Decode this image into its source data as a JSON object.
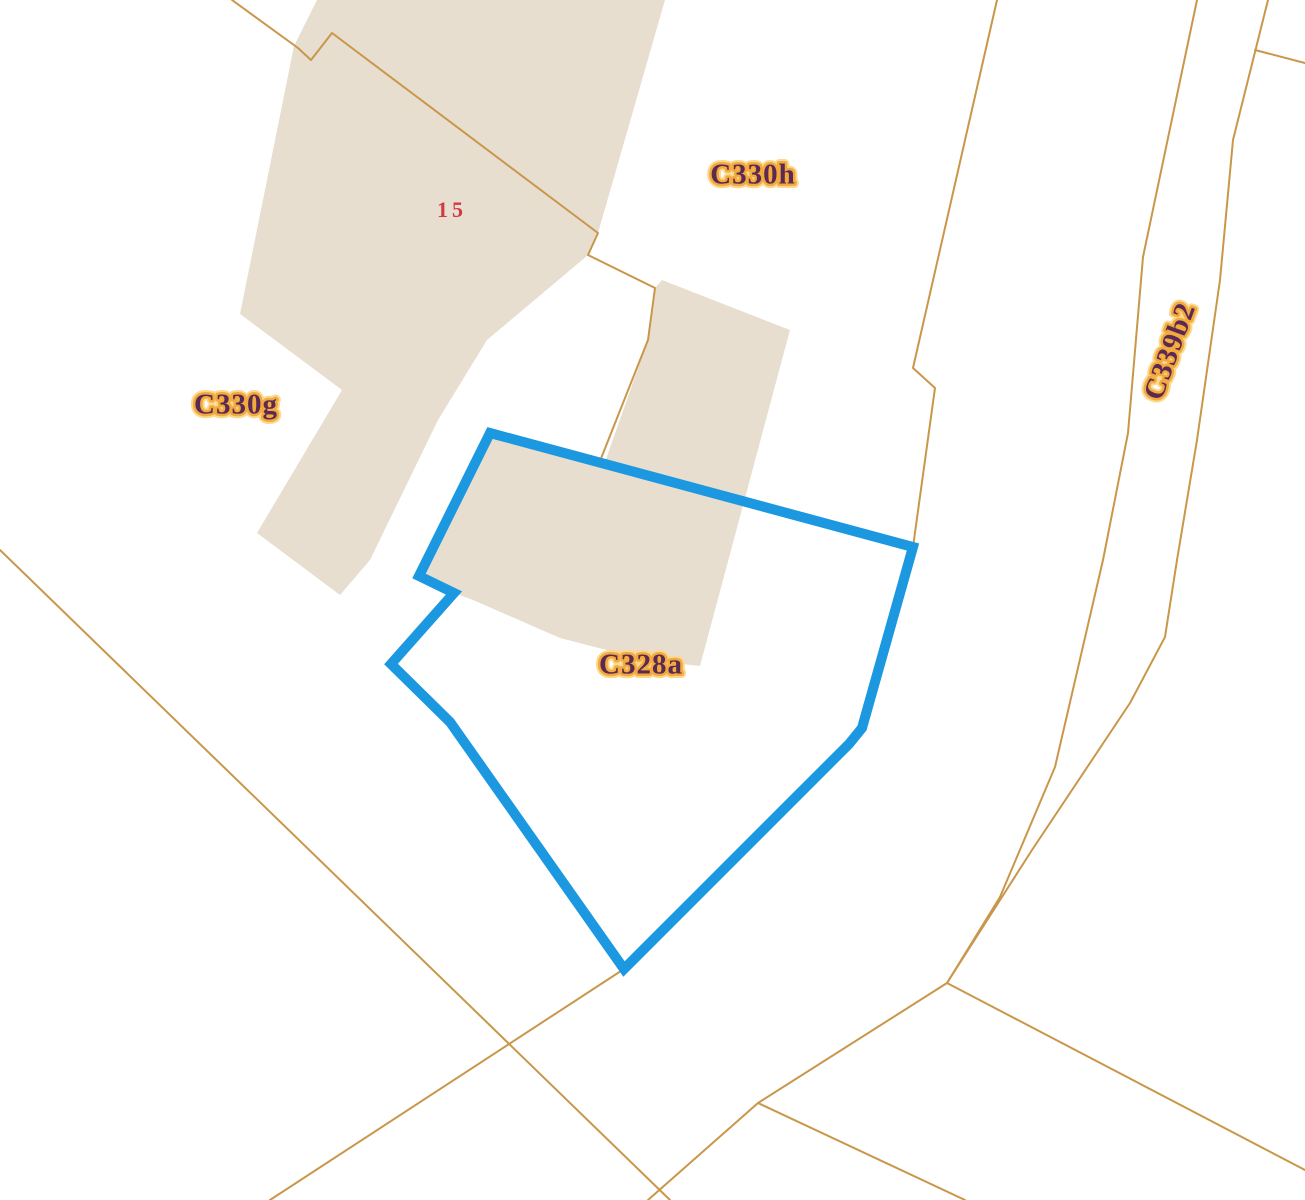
{
  "map": {
    "title": "cadastral-parcel-map",
    "colors": {
      "background": "#ffffff",
      "building_fill": "#e7decf",
      "boundary_line": "#c9974a",
      "selected_parcel_stroke": "#1b98e0",
      "label_fill": "#5a2a52",
      "label_halo": "#f3a93d",
      "label_halo_glow": "#fbd98d",
      "house_number_color": "#cf3a45"
    },
    "labels": [
      {
        "id": "c330h",
        "text": "C330h",
        "x": 753,
        "y": 177,
        "rotation": 0,
        "font_size": 29,
        "type": "parcel"
      },
      {
        "id": "c330g",
        "text": "C330g",
        "x": 236,
        "y": 407,
        "rotation": 0,
        "font_size": 29,
        "type": "parcel"
      },
      {
        "id": "c328a",
        "text": "C328a",
        "x": 641,
        "y": 667,
        "rotation": 0,
        "font_size": 29,
        "type": "parcel"
      },
      {
        "id": "c339b2",
        "text": "C339b2",
        "x": 1172,
        "y": 352,
        "rotation": -70,
        "font_size": 29,
        "type": "parcel"
      },
      {
        "id": "house-15",
        "text": "15",
        "x": 452,
        "y": 212,
        "rotation": 0,
        "font_size": 22,
        "type": "house-number"
      }
    ],
    "selected_parcel": {
      "label": "C328a",
      "stroke_width": 10,
      "points": [
        [
          490,
          433
        ],
        [
          913,
          547
        ],
        [
          862,
          728
        ],
        [
          849,
          744
        ],
        [
          624,
          969
        ],
        [
          450,
          722
        ],
        [
          391,
          664
        ],
        [
          454,
          593
        ],
        [
          419,
          576
        ]
      ]
    },
    "buildings": [
      {
        "name": "building-15",
        "points": [
          [
            317,
            0
          ],
          [
            665,
            0
          ],
          [
            598,
            233
          ],
          [
            588,
            255
          ],
          [
            487,
            340
          ],
          [
            438,
            420
          ],
          [
            370,
            560
          ],
          [
            340,
            595
          ],
          [
            257,
            533
          ],
          [
            342,
            390
          ],
          [
            240,
            314
          ],
          [
            294,
            46
          ]
        ]
      },
      {
        "name": "building-c328a",
        "points": [
          [
            655,
            288
          ],
          [
            662,
            280
          ],
          [
            790,
            330
          ],
          [
            700,
            666
          ],
          [
            645,
            660
          ],
          [
            560,
            638
          ],
          [
            473,
            600
          ],
          [
            454,
            593
          ],
          [
            419,
            576
          ],
          [
            490,
            434
          ],
          [
            605,
            462
          ],
          [
            648,
            340
          ]
        ]
      }
    ],
    "boundary_lines": [
      {
        "name": "parcel-line-through-building-15",
        "points": [
          [
            232,
            0
          ],
          [
            298,
            48
          ],
          [
            311,
            60
          ],
          [
            332,
            33
          ],
          [
            598,
            233
          ],
          [
            588,
            255
          ],
          [
            655,
            288
          ],
          [
            648,
            340
          ],
          [
            600,
            461
          ]
        ]
      },
      {
        "name": "parcel-line-to-blue-vertex",
        "points": [
          [
            997,
            0
          ],
          [
            913,
            368
          ],
          [
            935,
            388
          ],
          [
            913,
            547
          ]
        ]
      },
      {
        "name": "road-c339b2-left-edge",
        "points": [
          [
            1197,
            0
          ],
          [
            1143,
            257
          ],
          [
            1128,
            433
          ],
          [
            1103,
            560
          ],
          [
            1055,
            767
          ],
          [
            1000,
            897
          ],
          [
            947,
            983
          ]
        ]
      },
      {
        "name": "road-c339b2-right-edge",
        "points": [
          [
            1268,
            0
          ],
          [
            1233,
            140
          ],
          [
            1220,
            280
          ],
          [
            1197,
            440
          ],
          [
            1177,
            560
          ],
          [
            1165,
            637
          ],
          [
            1130,
            703
          ],
          [
            1032,
            850
          ],
          [
            947,
            983
          ]
        ]
      },
      {
        "name": "spur-top-right",
        "points": [
          [
            1255,
            50
          ],
          [
            1305,
            63
          ]
        ]
      },
      {
        "name": "road-southwest",
        "points": [
          [
            0,
            550
          ],
          [
            670,
            1200
          ]
        ]
      },
      {
        "name": "boundary-from-blue-vertex",
        "points": [
          [
            624,
            969
          ],
          [
            270,
            1200
          ]
        ]
      },
      {
        "name": "junction-line-west",
        "points": [
          [
            947,
            983
          ],
          [
            758,
            1103
          ],
          [
            648,
            1200
          ]
        ]
      },
      {
        "name": "junction-line-southeast",
        "points": [
          [
            947,
            983
          ],
          [
            1305,
            1170
          ]
        ]
      },
      {
        "name": "junction-line-south",
        "points": [
          [
            758,
            1103
          ],
          [
            965,
            1200
          ]
        ]
      }
    ]
  }
}
